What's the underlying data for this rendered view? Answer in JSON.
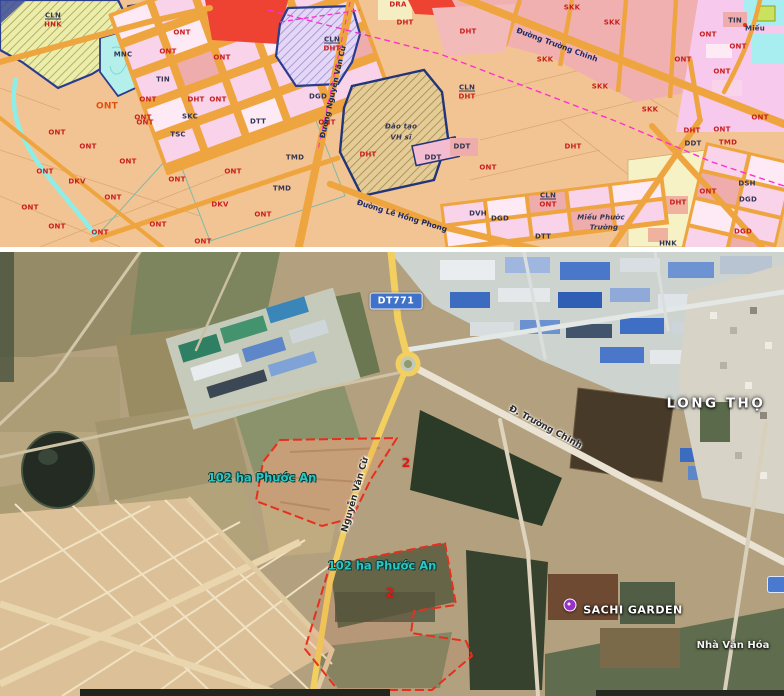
{
  "palette": {
    "planning_bg": "#f3c493",
    "road_orange": "#efa53f",
    "block_pink": "#f8d3ea",
    "block_pink_light": "#fdeaf5",
    "block_salmon": "#eeacac",
    "red_zone": "#ee4333",
    "khaki_hatch": "#ecedaa",
    "purple_hatch": "#e3d6f7",
    "tan_hatch": "#e5cb95",
    "water_cyan": "#a8eef0",
    "boundary_navy": "#2a3c8c",
    "magenta_line": "#ff2fd0",
    "label_red": "#c81e1e",
    "label_dark": "#343552",
    "sat_yellow_road": "#f2cf5e",
    "sat_badge_blue": "#3f72c8",
    "parcel_red": "#e6301d",
    "parcel_label_teal": "#2cc5c0",
    "poi_pin_purple": "#9b30c8"
  },
  "planning_map": {
    "labels": [
      {
        "text": "CLN",
        "x": 53,
        "y": 16,
        "cls": "dark u"
      },
      {
        "text": "HNK",
        "x": 53,
        "y": 25,
        "cls": "red"
      },
      {
        "text": "MNC",
        "x": 123,
        "y": 55,
        "cls": "dark"
      },
      {
        "text": "TIN",
        "x": 163,
        "y": 80,
        "cls": "dark"
      },
      {
        "text": "DHT",
        "x": 196,
        "y": 100,
        "cls": "red"
      },
      {
        "text": "SKC",
        "x": 190,
        "y": 117,
        "cls": "dark"
      },
      {
        "text": "TSC",
        "x": 178,
        "y": 135,
        "cls": "dark"
      },
      {
        "text": "DTT",
        "x": 258,
        "y": 122,
        "cls": "dark"
      },
      {
        "text": "DGD",
        "x": 318,
        "y": 97,
        "cls": "dark"
      },
      {
        "text": "TMD",
        "x": 295,
        "y": 158,
        "cls": "dark"
      },
      {
        "text": "TMD",
        "x": 282,
        "y": 189,
        "cls": "dark"
      },
      {
        "text": "DKV",
        "x": 77,
        "y": 182,
        "cls": "red"
      },
      {
        "text": "DKV",
        "x": 220,
        "y": 205,
        "cls": "red"
      },
      {
        "text": "ONT",
        "x": 107,
        "y": 107,
        "cls": "orange"
      },
      {
        "text": "ONT",
        "x": 182,
        "y": 33,
        "cls": "red"
      },
      {
        "text": "ONT",
        "x": 168,
        "y": 52,
        "cls": "red"
      },
      {
        "text": "ONT",
        "x": 222,
        "y": 58,
        "cls": "red"
      },
      {
        "text": "ONT",
        "x": 148,
        "y": 100,
        "cls": "red"
      },
      {
        "text": "ONT",
        "x": 218,
        "y": 100,
        "cls": "red"
      },
      {
        "text": "ONT",
        "x": 143,
        "y": 118,
        "cls": "red"
      },
      {
        "text": "ONT",
        "x": 145,
        "y": 123,
        "cls": "red"
      },
      {
        "text": "ONT",
        "x": 57,
        "y": 133,
        "cls": "red"
      },
      {
        "text": "ONT",
        "x": 88,
        "y": 147,
        "cls": "red"
      },
      {
        "text": "ONT",
        "x": 128,
        "y": 162,
        "cls": "red"
      },
      {
        "text": "ONT",
        "x": 45,
        "y": 172,
        "cls": "red"
      },
      {
        "text": "ONT",
        "x": 177,
        "y": 180,
        "cls": "red"
      },
      {
        "text": "ONT",
        "x": 113,
        "y": 198,
        "cls": "red"
      },
      {
        "text": "ONT",
        "x": 30,
        "y": 208,
        "cls": "red"
      },
      {
        "text": "ONT",
        "x": 158,
        "y": 225,
        "cls": "red"
      },
      {
        "text": "ONT",
        "x": 57,
        "y": 227,
        "cls": "red"
      },
      {
        "text": "ONT",
        "x": 100,
        "y": 233,
        "cls": "red"
      },
      {
        "text": "ONT",
        "x": 203,
        "y": 242,
        "cls": "red"
      },
      {
        "text": "ONT",
        "x": 233,
        "y": 172,
        "cls": "red"
      },
      {
        "text": "ONT",
        "x": 263,
        "y": 215,
        "cls": "red"
      },
      {
        "text": "ONT",
        "x": 327,
        "y": 123,
        "cls": "red"
      },
      {
        "text": "CLN",
        "x": 332,
        "y": 40,
        "cls": "dark u"
      },
      {
        "text": "DHT",
        "x": 332,
        "y": 49,
        "cls": "red"
      },
      {
        "text": "DRA",
        "x": 398,
        "y": 5,
        "cls": "red"
      },
      {
        "text": "DHT",
        "x": 405,
        "y": 23,
        "cls": "red"
      },
      {
        "text": "DHT",
        "x": 368,
        "y": 155,
        "cls": "red"
      },
      {
        "text": "Đào tạo",
        "x": 401,
        "y": 127,
        "cls": "dark it"
      },
      {
        "text": "VH sĩ",
        "x": 401,
        "y": 138,
        "cls": "dark it"
      },
      {
        "text": "DDT",
        "x": 462,
        "y": 147,
        "cls": "dark"
      },
      {
        "text": "DDT",
        "x": 433,
        "y": 158,
        "cls": "dark"
      },
      {
        "text": "DHT",
        "x": 468,
        "y": 32,
        "cls": "red"
      },
      {
        "text": "SKK",
        "x": 572,
        "y": 8,
        "cls": "red"
      },
      {
        "text": "SKK",
        "x": 612,
        "y": 23,
        "cls": "red"
      },
      {
        "text": "SKK",
        "x": 545,
        "y": 60,
        "cls": "red"
      },
      {
        "text": "SKK",
        "x": 600,
        "y": 87,
        "cls": "red"
      },
      {
        "text": "SKK",
        "x": 650,
        "y": 110,
        "cls": "red"
      },
      {
        "text": "CLN",
        "x": 467,
        "y": 88,
        "cls": "dark u"
      },
      {
        "text": "DHT",
        "x": 467,
        "y": 97,
        "cls": "red"
      },
      {
        "text": "ONT",
        "x": 488,
        "y": 168,
        "cls": "red"
      },
      {
        "text": "DHT",
        "x": 573,
        "y": 147,
        "cls": "red"
      },
      {
        "text": "CLN",
        "x": 548,
        "y": 196,
        "cls": "dark u"
      },
      {
        "text": "ONT",
        "x": 548,
        "y": 205,
        "cls": "red"
      },
      {
        "text": "DVH",
        "x": 478,
        "y": 214,
        "cls": "dark"
      },
      {
        "text": "DGD",
        "x": 500,
        "y": 219,
        "cls": "dark"
      },
      {
        "text": "DTT",
        "x": 543,
        "y": 237,
        "cls": "dark"
      },
      {
        "text": "Miếu Phước",
        "x": 601,
        "y": 218,
        "cls": "dark it"
      },
      {
        "text": "Trường",
        "x": 604,
        "y": 228,
        "cls": "dark it"
      },
      {
        "text": "HNK",
        "x": 668,
        "y": 244,
        "cls": "dark"
      },
      {
        "text": "DHT",
        "x": 678,
        "y": 203,
        "cls": "red"
      },
      {
        "text": "ONT",
        "x": 708,
        "y": 192,
        "cls": "red"
      },
      {
        "text": "DHT",
        "x": 692,
        "y": 131,
        "cls": "red"
      },
      {
        "text": "DDT",
        "x": 693,
        "y": 144,
        "cls": "dark"
      },
      {
        "text": "ONT",
        "x": 722,
        "y": 130,
        "cls": "red"
      },
      {
        "text": "TMD",
        "x": 728,
        "y": 143,
        "cls": "red"
      },
      {
        "text": "DSH",
        "x": 747,
        "y": 184,
        "cls": "dark"
      },
      {
        "text": "DGD",
        "x": 748,
        "y": 200,
        "cls": "dark"
      },
      {
        "text": "DGD",
        "x": 743,
        "y": 232,
        "cls": "red"
      },
      {
        "text": "TIN",
        "x": 735,
        "y": 21,
        "cls": "dark"
      },
      {
        "text": "Miếu",
        "x": 755,
        "y": 29,
        "cls": "dark"
      },
      {
        "text": "ONT",
        "x": 708,
        "y": 35,
        "cls": "red"
      },
      {
        "text": "ONT",
        "x": 738,
        "y": 47,
        "cls": "red"
      },
      {
        "text": "ONT",
        "x": 683,
        "y": 60,
        "cls": "red"
      },
      {
        "text": "ONT",
        "x": 722,
        "y": 72,
        "cls": "red"
      },
      {
        "text": "ONT",
        "x": 760,
        "y": 118,
        "cls": "red"
      }
    ],
    "streets": [
      {
        "text": "Đường Nguyễn Văn Cừ",
        "x": 333,
        "y": 92,
        "rot": -77
      },
      {
        "text": "Đường Trường Chinh",
        "x": 557,
        "y": 45,
        "rot": 20
      },
      {
        "text": "Đường Lê Hồng Phong",
        "x": 402,
        "y": 216,
        "rot": 17
      }
    ]
  },
  "satellite_map": {
    "road_badge": {
      "text": "DT771",
      "x": 396,
      "y": 49
    },
    "labels": [
      {
        "text": "LONG THỌ",
        "x": 716,
        "y": 152,
        "type": "place-lg",
        "name": "place-label-long-tho"
      },
      {
        "text": "102 ha Phước An",
        "x": 262,
        "y": 226,
        "type": "teal",
        "name": "parcel-label-1"
      },
      {
        "text": "102 ha Phước An",
        "x": 382,
        "y": 314,
        "type": "teal",
        "name": "parcel-label-2"
      },
      {
        "text": "2",
        "x": 406,
        "y": 211,
        "type": "marker",
        "name": "parcel-marker-1"
      },
      {
        "text": "2",
        "x": 390,
        "y": 341,
        "type": "marker",
        "name": "parcel-marker-2"
      },
      {
        "text": "SACHI GARDEN",
        "x": 633,
        "y": 358,
        "type": "place",
        "name": "poi-label-sachi-garden"
      },
      {
        "text": "Nhà Văn Hóa",
        "x": 733,
        "y": 394,
        "type": "place-sm",
        "name": "place-label-nha-van-hoa"
      },
      {
        "text": "Đ. Trường Chinh",
        "x": 545,
        "y": 176,
        "type": "road",
        "rot": 28,
        "name": "road-label-truong-chinh"
      },
      {
        "text": "Nguyễn Văn Cừ",
        "x": 356,
        "y": 243,
        "type": "road",
        "rot": -74,
        "name": "road-label-nguyen-van-cu"
      }
    ],
    "poi_pin": {
      "x": 570,
      "y": 353
    },
    "partial_badge": {
      "x": 767,
      "y": 324
    }
  }
}
